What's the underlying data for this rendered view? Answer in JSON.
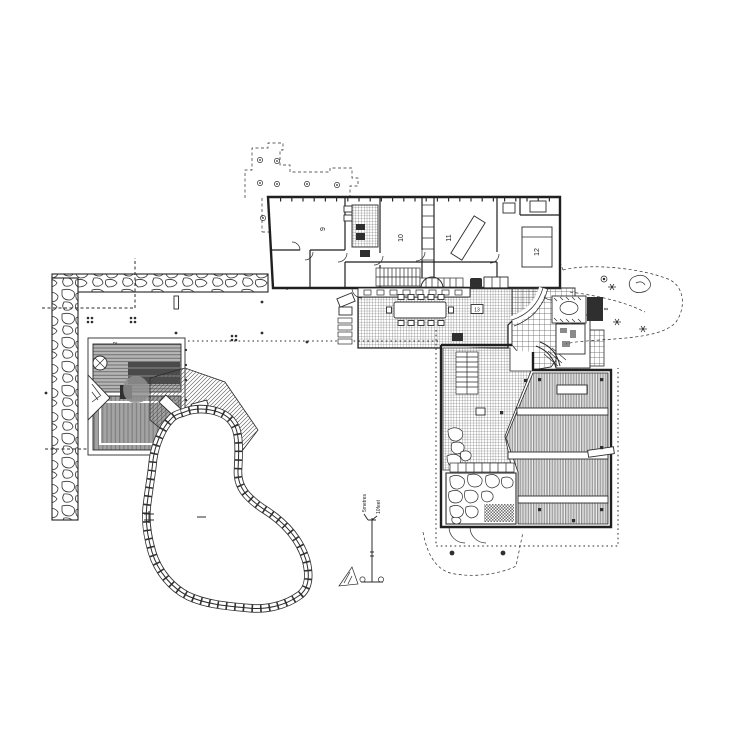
{
  "plan": {
    "room_labels": {
      "sauna": "2",
      "entry_court": "8",
      "room9": "9",
      "room10": "10",
      "room11": "11",
      "room12": "12",
      "upper_terrace": "13"
    },
    "scale_bar": {
      "metres": "5metres",
      "feet": "10feet"
    },
    "colors": {
      "ink": "#2b2b2b",
      "paper": "#ffffff",
      "dark_fill": "#2f2f2f",
      "mid_gray": "#8a8a8a",
      "sauna_roof": "#4a4a4a"
    }
  }
}
